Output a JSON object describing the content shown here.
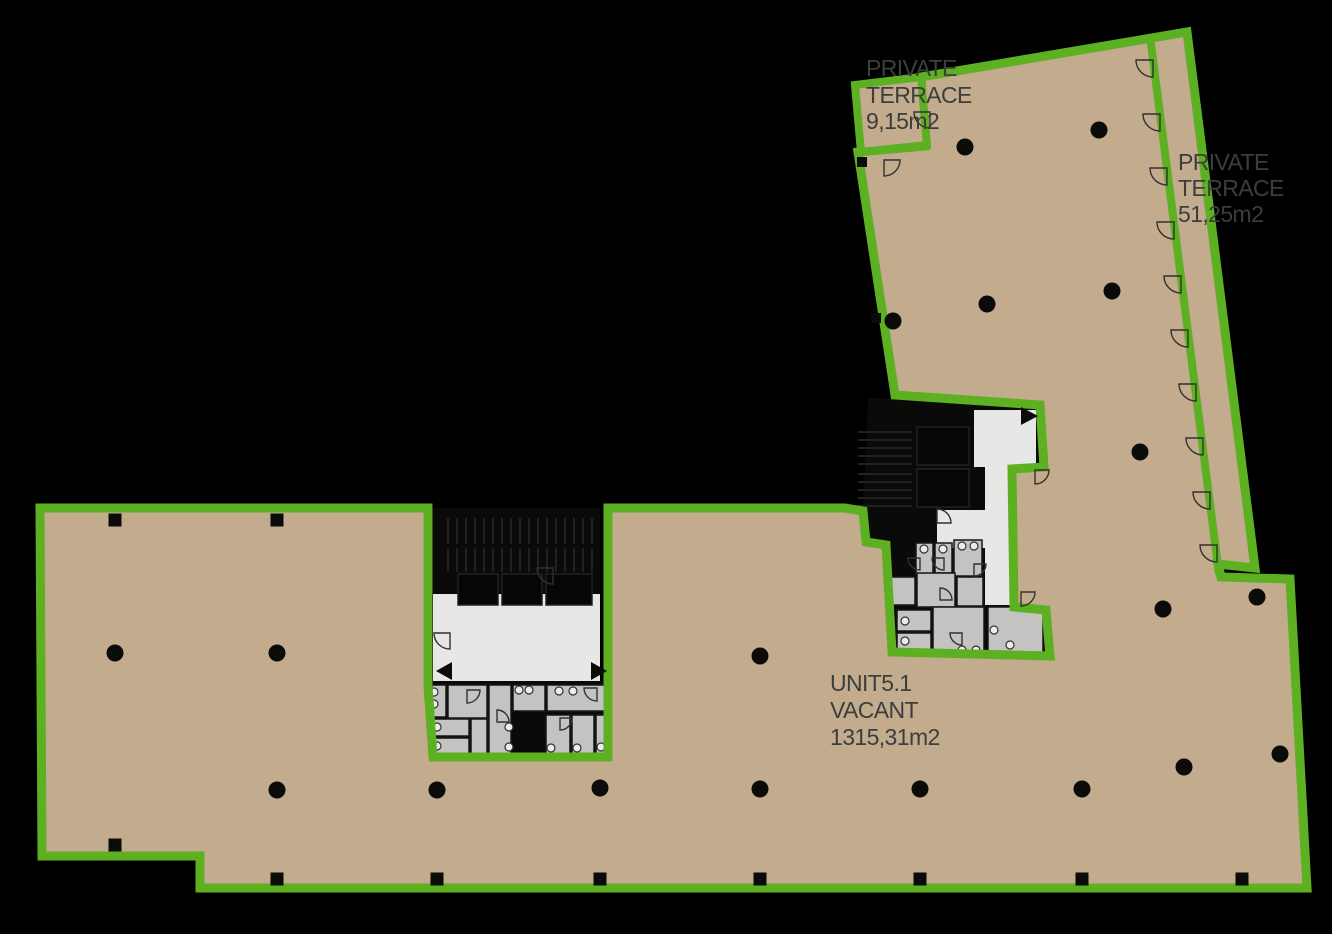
{
  "colors": {
    "bg": "#000000",
    "floor_tan": "#c3ab8e",
    "boundary_green": "#5cb022",
    "corridor_white": "#e7e7e5",
    "room_gray": "#c4c3c1",
    "core_black": "#0a0a09",
    "ink": "#0b0b0a",
    "stair_stripe": "#222120",
    "text_dark": "#3d3d3c"
  },
  "labels": {
    "terrace_small": {
      "lines": [
        "PRIVATE",
        "TERRACE",
        "9,15m2"
      ]
    },
    "terrace_large": {
      "lines": [
        "PRIVATE",
        "TERRACE",
        "51,25m2"
      ]
    },
    "unit": {
      "lines": [
        "UNIT5.1",
        "VACANT",
        "1315,31m2"
      ]
    }
  },
  "columns": {
    "round": [
      [
        965,
        147
      ],
      [
        1099,
        130
      ],
      [
        893,
        321
      ],
      [
        987,
        304
      ],
      [
        1112,
        291
      ],
      [
        1140,
        452
      ],
      [
        1163,
        609
      ],
      [
        1257,
        597
      ],
      [
        1184,
        767
      ],
      [
        1280,
        754
      ],
      [
        1082,
        789
      ],
      [
        115,
        653
      ],
      [
        277,
        653
      ],
      [
        760,
        656
      ],
      [
        277,
        790
      ],
      [
        437,
        790
      ],
      [
        600,
        788
      ],
      [
        760,
        789
      ],
      [
        920,
        789
      ]
    ],
    "square": [
      [
        115,
        520,
        13
      ],
      [
        277,
        520,
        13
      ],
      [
        862,
        162,
        10
      ],
      [
        876,
        318,
        10
      ],
      [
        115,
        845,
        13
      ],
      [
        277,
        879,
        13
      ],
      [
        437,
        879,
        13
      ],
      [
        600,
        879,
        13
      ],
      [
        760,
        879,
        13
      ],
      [
        920,
        879,
        13
      ],
      [
        1082,
        879,
        13
      ],
      [
        1242,
        879,
        13
      ]
    ]
  },
  "door_arcs": [
    [
      1153,
      60,
      17,
      180
    ],
    [
      1160,
      114,
      17,
      180
    ],
    [
      1167,
      168,
      17,
      180
    ],
    [
      1174,
      222,
      17,
      180
    ],
    [
      1181,
      276,
      17,
      180
    ],
    [
      1188,
      330,
      17,
      180
    ],
    [
      1196,
      384,
      17,
      180
    ],
    [
      1203,
      438,
      17,
      180
    ],
    [
      1210,
      492,
      17,
      180
    ],
    [
      1217,
      545,
      17,
      180
    ],
    [
      884,
      160,
      16,
      90
    ],
    [
      930,
      112,
      16,
      180
    ],
    [
      553,
      568,
      16,
      180
    ],
    [
      450,
      633,
      16,
      180
    ],
    [
      467,
      690,
      13,
      90
    ],
    [
      597,
      688,
      13,
      180
    ],
    [
      497,
      722,
      12,
      0
    ],
    [
      560,
      718,
      12,
      90
    ],
    [
      920,
      558,
      12,
      180
    ],
    [
      944,
      558,
      12,
      180
    ],
    [
      974,
      564,
      12,
      90
    ],
    [
      940,
      600,
      12,
      0
    ],
    [
      962,
      633,
      12,
      180
    ],
    [
      1021,
      592,
      14,
      90
    ],
    [
      937,
      523,
      14,
      0
    ],
    [
      1035,
      470,
      14,
      90
    ]
  ],
  "rooms": {
    "cells_lower": [
      [
        432,
        685,
        14,
        32
      ],
      [
        448,
        685,
        39,
        33
      ],
      [
        489,
        685,
        22,
        70
      ],
      [
        513,
        685,
        32,
        26
      ],
      [
        547,
        685,
        60,
        26
      ],
      [
        432,
        719,
        37,
        17
      ],
      [
        432,
        738,
        37,
        17
      ],
      [
        471,
        719,
        16,
        36
      ],
      [
        546,
        715,
        24,
        40
      ],
      [
        572,
        715,
        22,
        40
      ],
      [
        596,
        715,
        12,
        40
      ]
    ],
    "cells_upper": [
      [
        916,
        543,
        17,
        32
      ],
      [
        935,
        543,
        17,
        30
      ],
      [
        954,
        540,
        28,
        36
      ],
      [
        890,
        577,
        25,
        28
      ],
      [
        917,
        573,
        38,
        34
      ],
      [
        957,
        577,
        26,
        29
      ],
      [
        897,
        610,
        34,
        21
      ],
      [
        897,
        633,
        34,
        19
      ],
      [
        933,
        607,
        51,
        45
      ],
      [
        988,
        607,
        55,
        49
      ]
    ],
    "shafts": [
      [
        521,
        713,
        24,
        44
      ]
    ],
    "fixtures": [
      [
        434,
        692
      ],
      [
        434,
        704
      ],
      [
        519,
        690
      ],
      [
        529,
        690
      ],
      [
        559,
        691
      ],
      [
        573,
        691
      ],
      [
        437,
        727
      ],
      [
        437,
        746
      ],
      [
        509,
        727
      ],
      [
        509,
        747
      ],
      [
        551,
        748
      ],
      [
        577,
        748
      ],
      [
        601,
        747
      ],
      [
        924,
        549
      ],
      [
        943,
        549
      ],
      [
        962,
        546
      ],
      [
        974,
        546
      ],
      [
        905,
        621
      ],
      [
        905,
        641
      ],
      [
        962,
        650
      ],
      [
        976,
        650
      ],
      [
        994,
        630
      ],
      [
        1010,
        645
      ]
    ]
  },
  "stair_blocks": [
    {
      "x": 448,
      "y": 518,
      "w": 144,
      "h": 26,
      "step": 9,
      "dir": "v"
    },
    {
      "x": 448,
      "y": 548,
      "w": 144,
      "h": 24,
      "step": 9,
      "dir": "v"
    },
    {
      "x": 858,
      "y": 432,
      "w": 54,
      "h": 38,
      "step": 8,
      "dir": "h"
    },
    {
      "x": 858,
      "y": 474,
      "w": 54,
      "h": 38,
      "step": 8,
      "dir": "h"
    }
  ],
  "lift_boxes": [
    [
      458,
      574,
      40,
      31
    ],
    [
      502,
      574,
      40,
      31
    ],
    [
      546,
      574,
      46,
      31
    ],
    [
      917,
      427,
      52,
      38
    ],
    [
      917,
      469,
      52,
      38
    ]
  ],
  "arrows": [
    [
      452,
      662,
      436,
      671,
      452,
      680
    ],
    [
      591,
      662,
      607,
      671,
      591,
      680
    ],
    [
      1021,
      407,
      1038,
      416,
      1021,
      425
    ]
  ]
}
